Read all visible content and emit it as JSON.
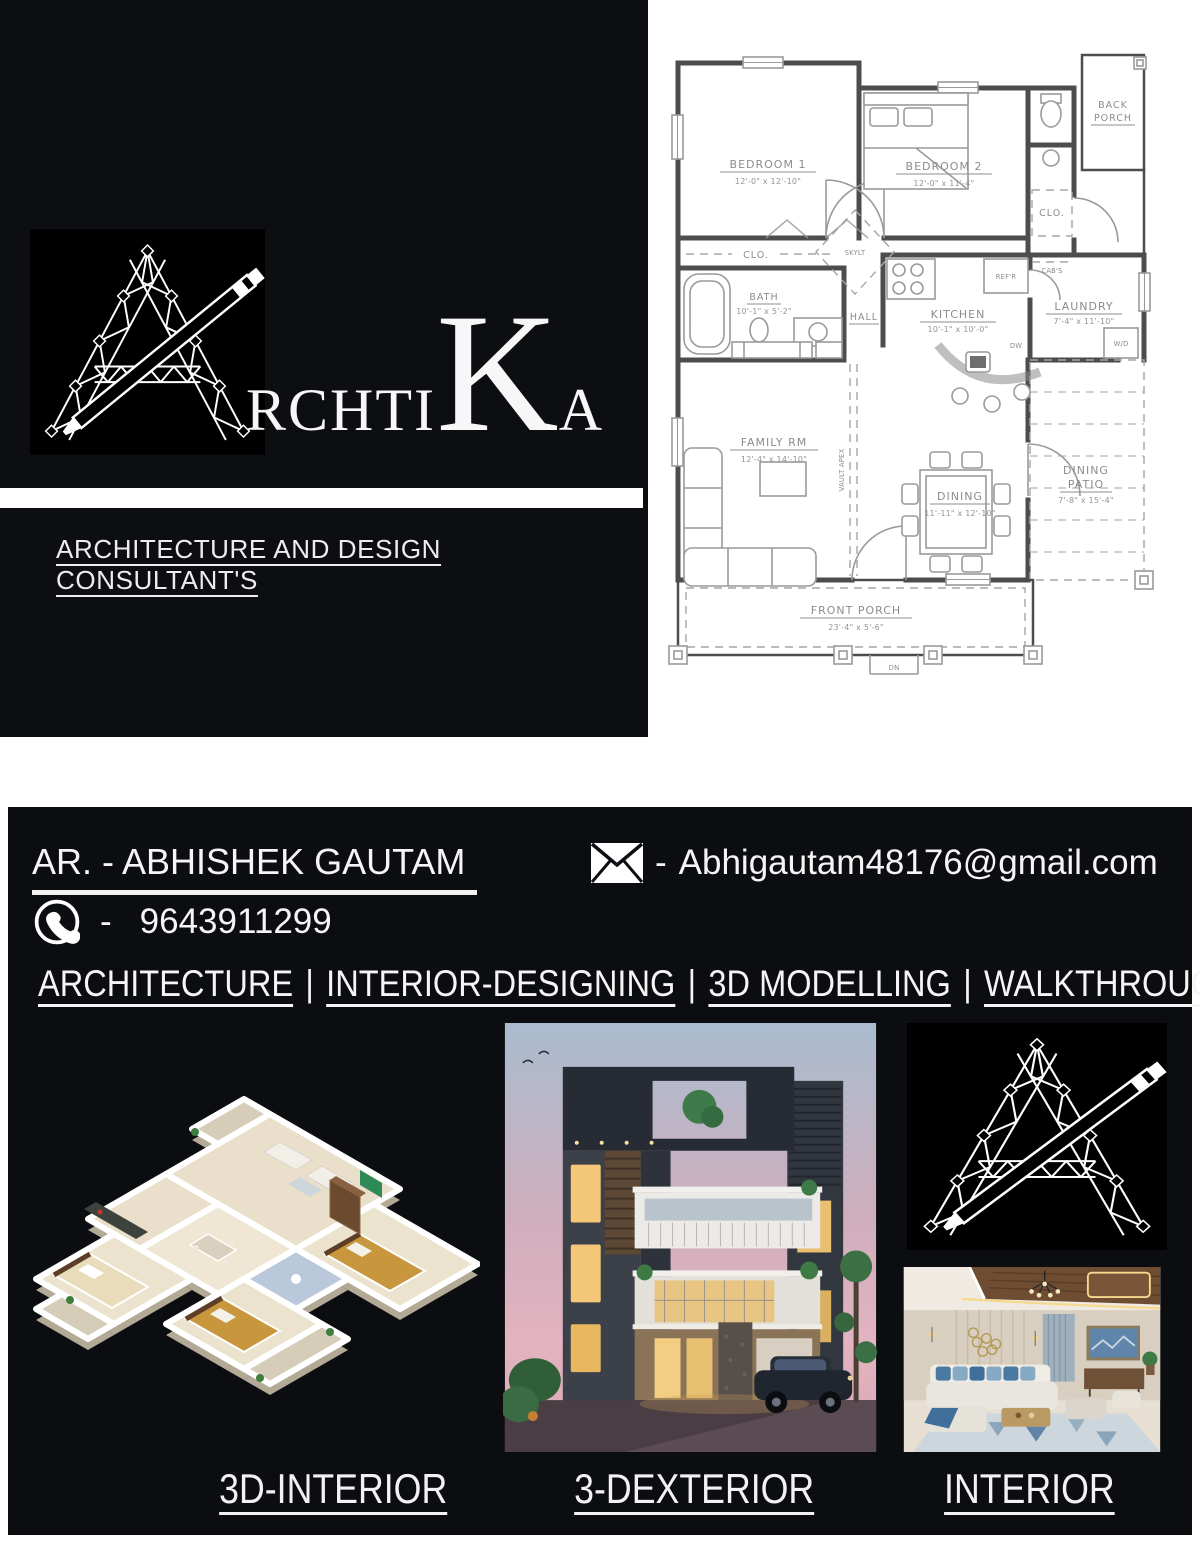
{
  "brand": {
    "wordmark": {
      "prefix": "RCHTI",
      "k": "K",
      "suffix": "A"
    },
    "tagline": "ARCHITECTURE AND DESIGN CONSULTANT'S"
  },
  "contact": {
    "title_line": "AR. -  ABHISHEK GAUTAM",
    "email_dash": "-",
    "email": "Abhigautam48176@gmail.com",
    "phone_dash": "-",
    "phone": "9643911299"
  },
  "services": {
    "separator": "|",
    "items": [
      "ARCHITECTURE",
      "INTERIOR-DESIGNING",
      "3D MODELLING",
      "WALKTHROUGH"
    ]
  },
  "portfolio": {
    "labels": [
      "3D-INTERIOR",
      "3-DEXTERIOR",
      "INTERIOR"
    ]
  },
  "floorplan": {
    "rooms": {
      "bedroom1": {
        "name": "BEDROOM 1",
        "dims": "12'-0\" x 12'-10\""
      },
      "bedroom2": {
        "name": "BEDROOM 2",
        "dims": "12'-0\" x 11'-4\""
      },
      "back_porch": {
        "line1": "BACK",
        "line2": "PORCH"
      },
      "closet1": {
        "name": "CLO."
      },
      "closet2": {
        "name": "CLO."
      },
      "bath": {
        "name": "BATH",
        "dims": "10'-1\" x 5'-2\""
      },
      "hall": {
        "name": "HALL"
      },
      "kitchen": {
        "name": "KITCHEN",
        "dims": "10'-1\" x 10'-0\""
      },
      "laundry": {
        "name": "LAUNDRY",
        "dims": "7'-4\" x 11'-10\""
      },
      "family_room": {
        "name": "FAMILY RM",
        "dims": "12'-4\" x 14'-10\""
      },
      "dining": {
        "name": "DINING",
        "dims": "11'-11\" x 12'-10\""
      },
      "dining_patio": {
        "line1": "DINING",
        "line2": "PATIO",
        "dims": "7'-8\" x 15'-4\""
      },
      "front_porch": {
        "name": "FRONT PORCH",
        "dims": "23'-4\" x 5'-6\""
      }
    },
    "annotations": {
      "refrigerator": "REF'R",
      "cabinets": "CAB'S",
      "washer_dryer": "W/D",
      "dishwasher": "DW",
      "skylight": "SKYLT",
      "vault_apex": "VAULT APEX",
      "down": "DN"
    }
  },
  "colors": {
    "panel_black": "#0b0d10",
    "logo_black": "#000000",
    "white": "#ffffff",
    "plan_line": "#4d4d4d",
    "plan_label": "#8c8c8c",
    "accent_warm_window": "#f4c878",
    "accent_dusk_pink": "#e3b3c0"
  }
}
